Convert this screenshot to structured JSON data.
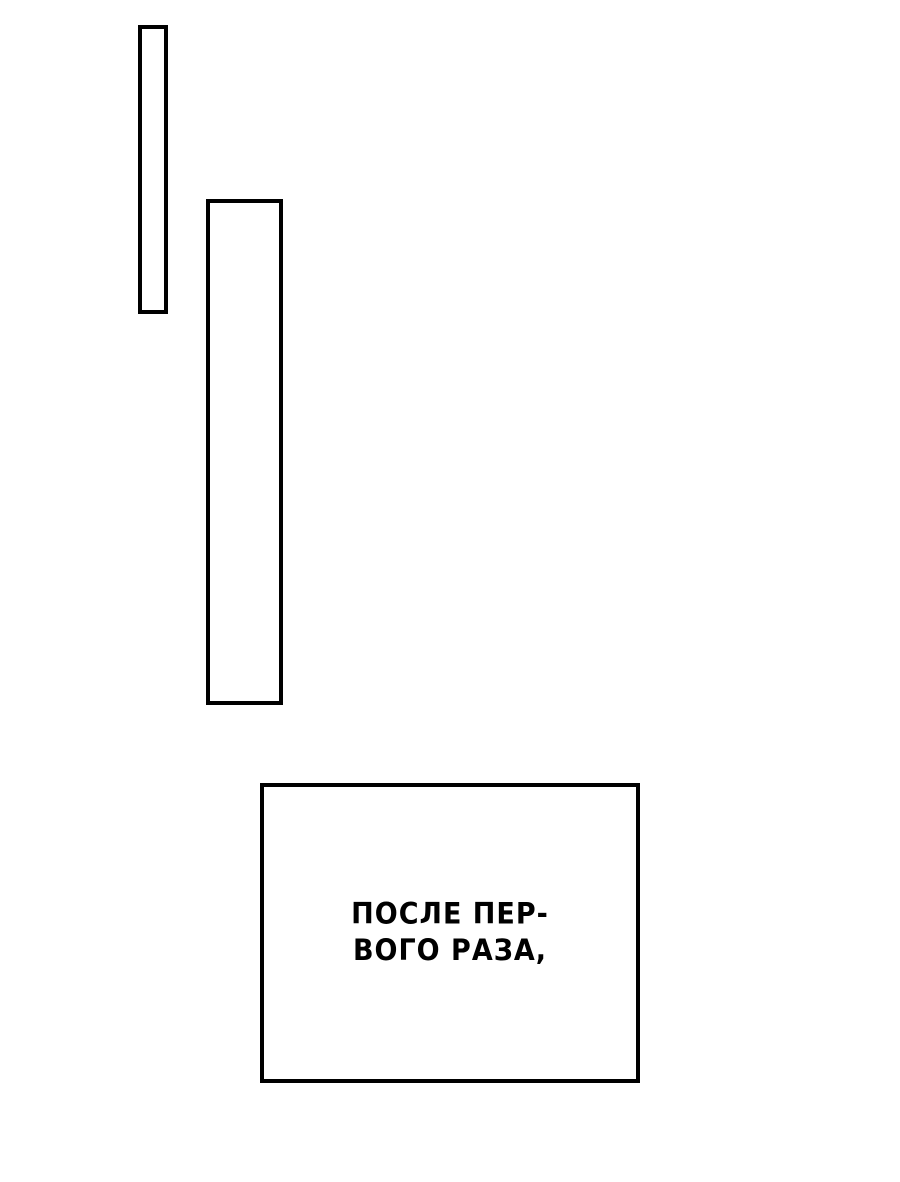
{
  "page": {
    "background_color": "#ffffff",
    "panel_border_color": "#000000",
    "text_color": "#000000"
  },
  "panels": [
    {
      "id": "panel-thin",
      "description": "empty thin vertical comic panel"
    },
    {
      "id": "panel-tall",
      "description": "empty tall vertical comic panel"
    },
    {
      "id": "caption-box",
      "description": "caption box with narration text"
    }
  ],
  "caption": {
    "line1": "ПОСЛЕ ПЕР-",
    "line2": "ВОГО РАЗА,",
    "full_text": "ПОСЛЕ ПЕРВОГО РАЗА,"
  }
}
